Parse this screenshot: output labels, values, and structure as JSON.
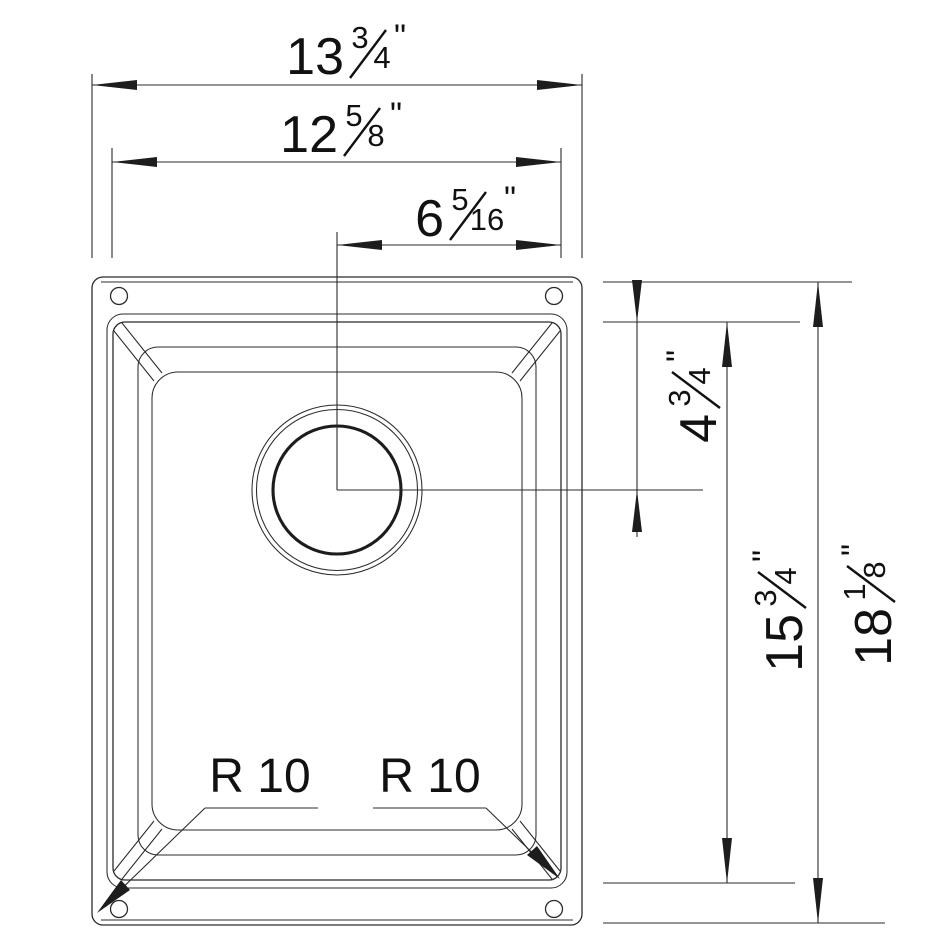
{
  "labels": {
    "overall_width": {
      "whole": "13",
      "num": "3",
      "den": "4",
      "unit": "\""
    },
    "bowl_width": {
      "whole": "12",
      "num": "5",
      "den": "8",
      "unit": "\""
    },
    "drain_offset_x": {
      "whole": "6",
      "num": "5",
      "den": "16",
      "unit": "\""
    },
    "drain_offset_y": {
      "whole": "4",
      "num": "3",
      "den": "4",
      "unit": "\""
    },
    "bowl_length": {
      "whole": "15",
      "num": "3",
      "den": "4",
      "unit": "\""
    },
    "overall_length": {
      "whole": "18",
      "num": "1",
      "den": "8",
      "unit": "\""
    },
    "corner_radius_left": "R 10",
    "corner_radius_right": "R 10"
  },
  "colors": {
    "line": "#2b2b2b",
    "text": "#111111",
    "background": "#ffffff"
  }
}
